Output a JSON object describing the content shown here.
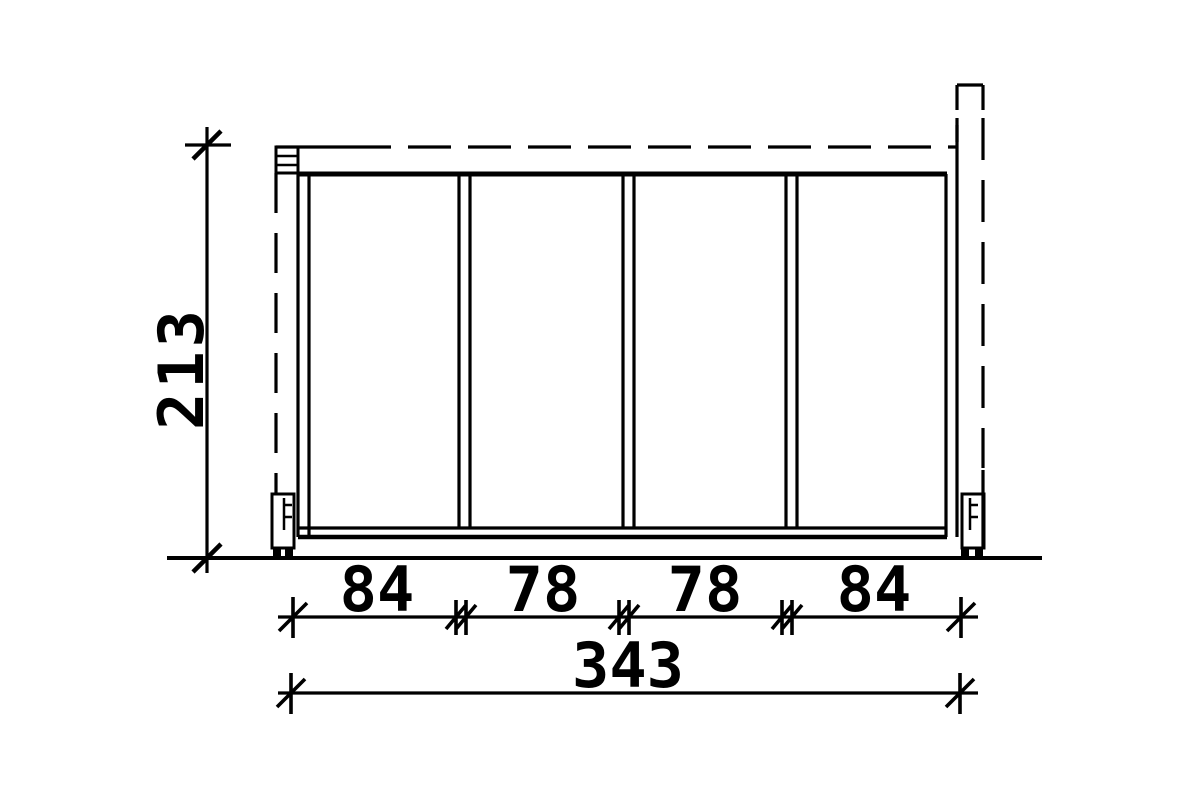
{
  "drawing": {
    "type": "technical-drawing",
    "subject": "side element with four panels, wall connection (dashed) and post (dashed), two post anchors",
    "colors": {
      "line": "#000000",
      "background": "#ffffff"
    }
  },
  "dimensions": {
    "height": {
      "value": 213,
      "label": "213"
    },
    "segments": [
      {
        "value": 84,
        "label": "84"
      },
      {
        "value": 78,
        "label": "78"
      },
      {
        "value": 78,
        "label": "78"
      },
      {
        "value": 84,
        "label": "84"
      }
    ],
    "total": {
      "value": 343,
      "label": "343"
    }
  }
}
